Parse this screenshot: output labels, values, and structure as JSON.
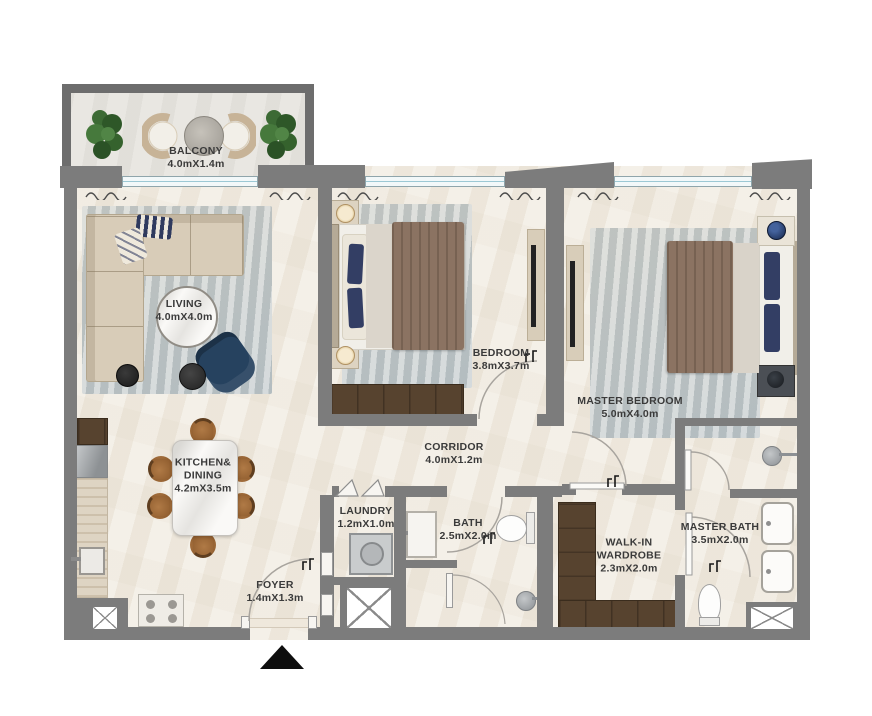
{
  "floorplan": {
    "rooms": {
      "balcony": {
        "name": "BALCONY",
        "dims": "4.0mX1.4m"
      },
      "living": {
        "name": "LIVING",
        "dims": "4.0mX4.0m"
      },
      "bedroom": {
        "name": "BEDROOM",
        "dims": "3.8mX3.7m"
      },
      "master_bedroom": {
        "name": "MASTER BEDROOM",
        "dims": "5.0mX4.0m"
      },
      "kitchen_dining": {
        "line1": "KITCHEN&",
        "line2": "DINING",
        "dims": "4.2mX3.5m"
      },
      "corridor": {
        "name": "CORRIDOR",
        "dims": "4.0mX1.2m"
      },
      "laundry": {
        "name": "LAUNDRY",
        "dims": "1.2mX1.0m"
      },
      "bath": {
        "name": "BATH",
        "dims": "2.5mX2.0m"
      },
      "walk_in_wardrobe": {
        "line1": "WALK-IN",
        "line2": "WARDROBE",
        "dims": "2.3mX2.0m"
      },
      "master_bath": {
        "name": "MASTER BATH",
        "dims": "3.5mX2.0m"
      },
      "foyer": {
        "name": "FOYER",
        "dims": "1.4mX1.3m"
      }
    },
    "palette": {
      "wall": "#7c7c7c",
      "balcony_wall": "#6d6d6d",
      "floor": "#f2ede3",
      "rug": "#d3d9da",
      "wood_dark": "#57432f",
      "sofa": "#d8ccb8",
      "blanket": "#8b7362",
      "navy": "#2c3e5f",
      "chair_brown": "#a9713d",
      "window_glass": "#9cc8d4",
      "label_text": "#3a3a3a"
    }
  }
}
